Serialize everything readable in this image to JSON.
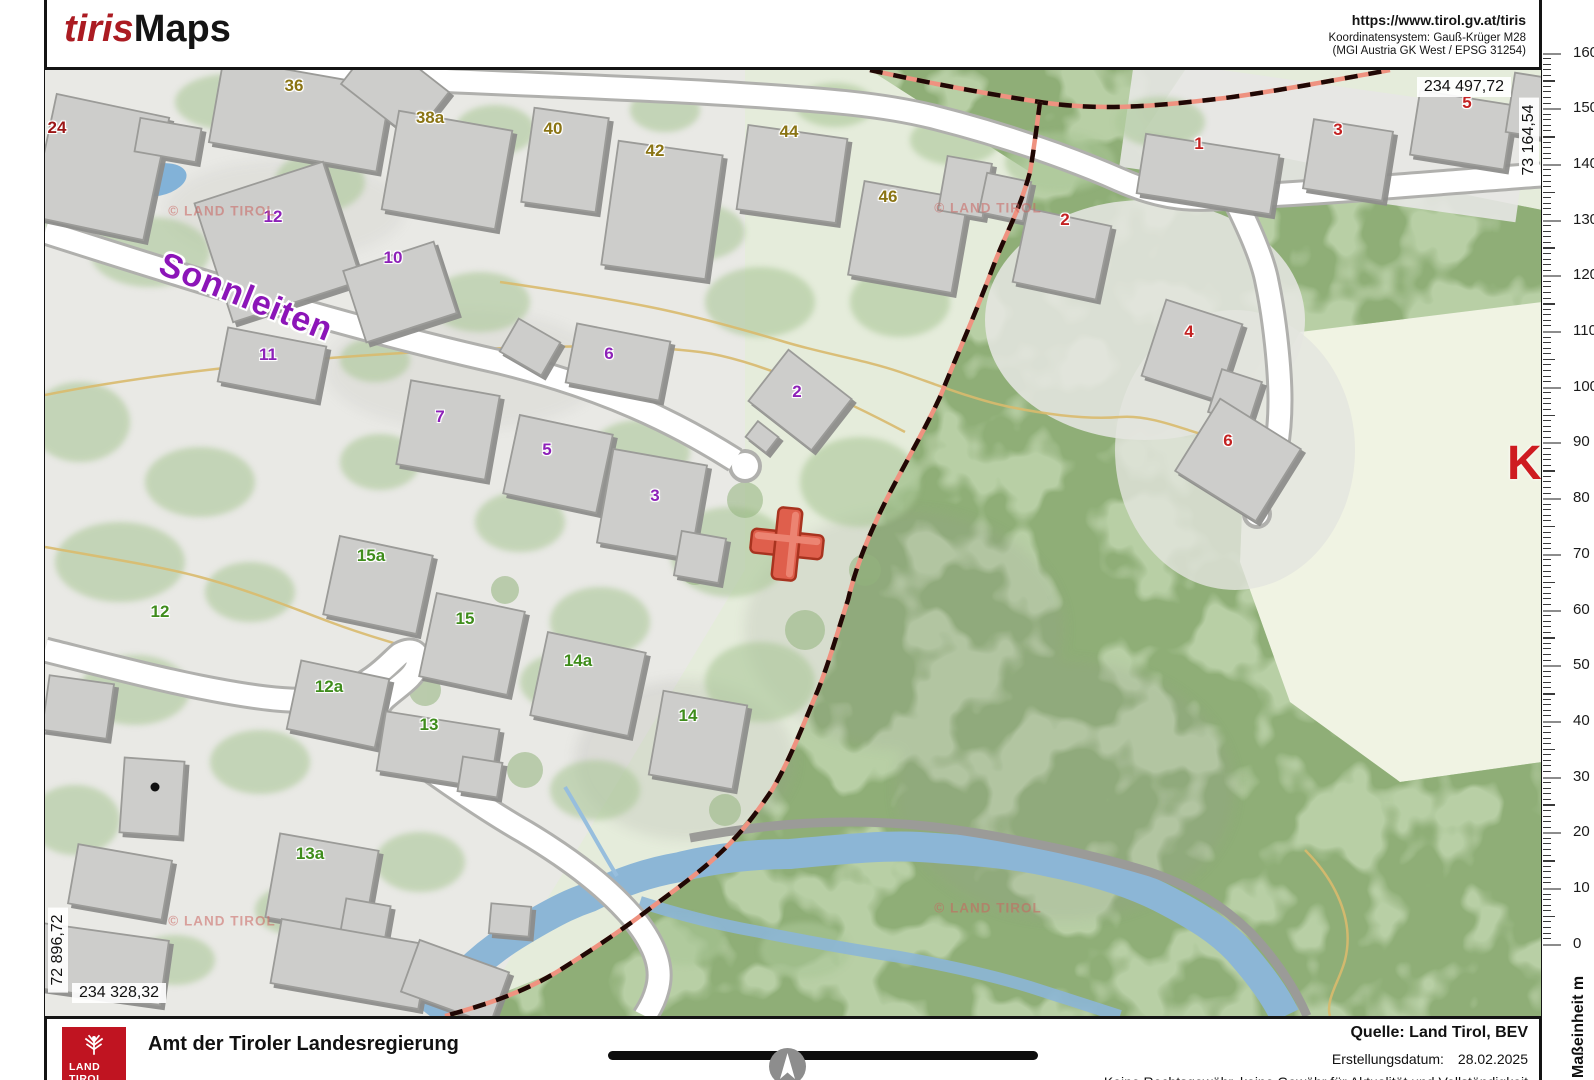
{
  "header": {
    "brand_tiris": "tiris",
    "brand_maps": "Maps",
    "url": "https://www.tirol.gv.at/tiris",
    "coord_system_line1": "Koordinatensystem: Gauß-Krüger M28",
    "coord_system_line2": "(MGI Austria GK West / EPSG 31254)"
  },
  "map": {
    "street_label": "Sonnleiten",
    "watermark": "© LAND TIROL",
    "big_place_letter": "K",
    "marker_color": "#df5f4c",
    "coordinates": {
      "top_right": "234 497,72",
      "right_vertical": "73 164,54",
      "left_vertical": "72 896,72",
      "bottom_left": "234 328,32"
    },
    "label_colors": {
      "yellow": "#8a7414",
      "purple": "#8d21b8",
      "red": "#c32222",
      "darkred": "#9c1616",
      "green": "#3f8c1c"
    },
    "house_numbers": [
      {
        "label": "36",
        "x": 294,
        "y": 86,
        "group": "yellow"
      },
      {
        "label": "38a",
        "x": 430,
        "y": 118,
        "group": "yellow"
      },
      {
        "label": "40",
        "x": 553,
        "y": 129,
        "group": "yellow"
      },
      {
        "label": "42",
        "x": 655,
        "y": 151,
        "group": "yellow"
      },
      {
        "label": "44",
        "x": 789,
        "y": 132,
        "group": "yellow"
      },
      {
        "label": "46",
        "x": 888,
        "y": 197,
        "group": "yellow"
      },
      {
        "label": "24",
        "x": 57,
        "y": 128,
        "group": "darkred"
      },
      {
        "label": "12",
        "x": 273,
        "y": 217,
        "group": "purple"
      },
      {
        "label": "10",
        "x": 393,
        "y": 258,
        "group": "purple"
      },
      {
        "label": "11",
        "x": 268,
        "y": 355,
        "group": "purple"
      },
      {
        "label": "6",
        "x": 609,
        "y": 354,
        "group": "purple"
      },
      {
        "label": "2",
        "x": 797,
        "y": 392,
        "group": "purple"
      },
      {
        "label": "7",
        "x": 440,
        "y": 417,
        "group": "purple"
      },
      {
        "label": "5",
        "x": 547,
        "y": 450,
        "group": "purple"
      },
      {
        "label": "3",
        "x": 655,
        "y": 496,
        "group": "purple"
      },
      {
        "label": "1",
        "x": 1199,
        "y": 144,
        "group": "red"
      },
      {
        "label": "3",
        "x": 1338,
        "y": 130,
        "group": "red"
      },
      {
        "label": "5",
        "x": 1467,
        "y": 103,
        "group": "red"
      },
      {
        "label": "2",
        "x": 1065,
        "y": 220,
        "group": "red"
      },
      {
        "label": "4",
        "x": 1189,
        "y": 332,
        "group": "red"
      },
      {
        "label": "6",
        "x": 1228,
        "y": 441,
        "group": "red"
      },
      {
        "label": "15a",
        "x": 371,
        "y": 556,
        "group": "green"
      },
      {
        "label": "12",
        "x": 160,
        "y": 612,
        "group": "green"
      },
      {
        "label": "15",
        "x": 465,
        "y": 619,
        "group": "green"
      },
      {
        "label": "14a",
        "x": 578,
        "y": 661,
        "group": "green"
      },
      {
        "label": "12a",
        "x": 329,
        "y": 687,
        "group": "green"
      },
      {
        "label": "13",
        "x": 429,
        "y": 725,
        "group": "green"
      },
      {
        "label": "14",
        "x": 688,
        "y": 716,
        "group": "green"
      },
      {
        "label": "13a",
        "x": 310,
        "y": 854,
        "group": "green"
      }
    ]
  },
  "ruler": {
    "values": [
      "160",
      "150",
      "140",
      "130",
      "120",
      "110",
      "100",
      "90",
      "80",
      "70",
      "60",
      "50",
      "40",
      "30",
      "20",
      "10",
      "0"
    ],
    "unit_label": "Maßeinheit m"
  },
  "footer": {
    "logo_line1": "LAND",
    "logo_line2": "TIROL",
    "logo_color": "#c01421",
    "agency": "Amt der Tiroler Landesregierung",
    "source_label": "Quelle: Land Tirol, BEV",
    "date_label": "Erstellungsdatum:",
    "date_value": "28.02.2025",
    "disclaimer": "Keine Rechtsgewähr, keine Gewähr für Aktualität und Vollständigkeit"
  }
}
